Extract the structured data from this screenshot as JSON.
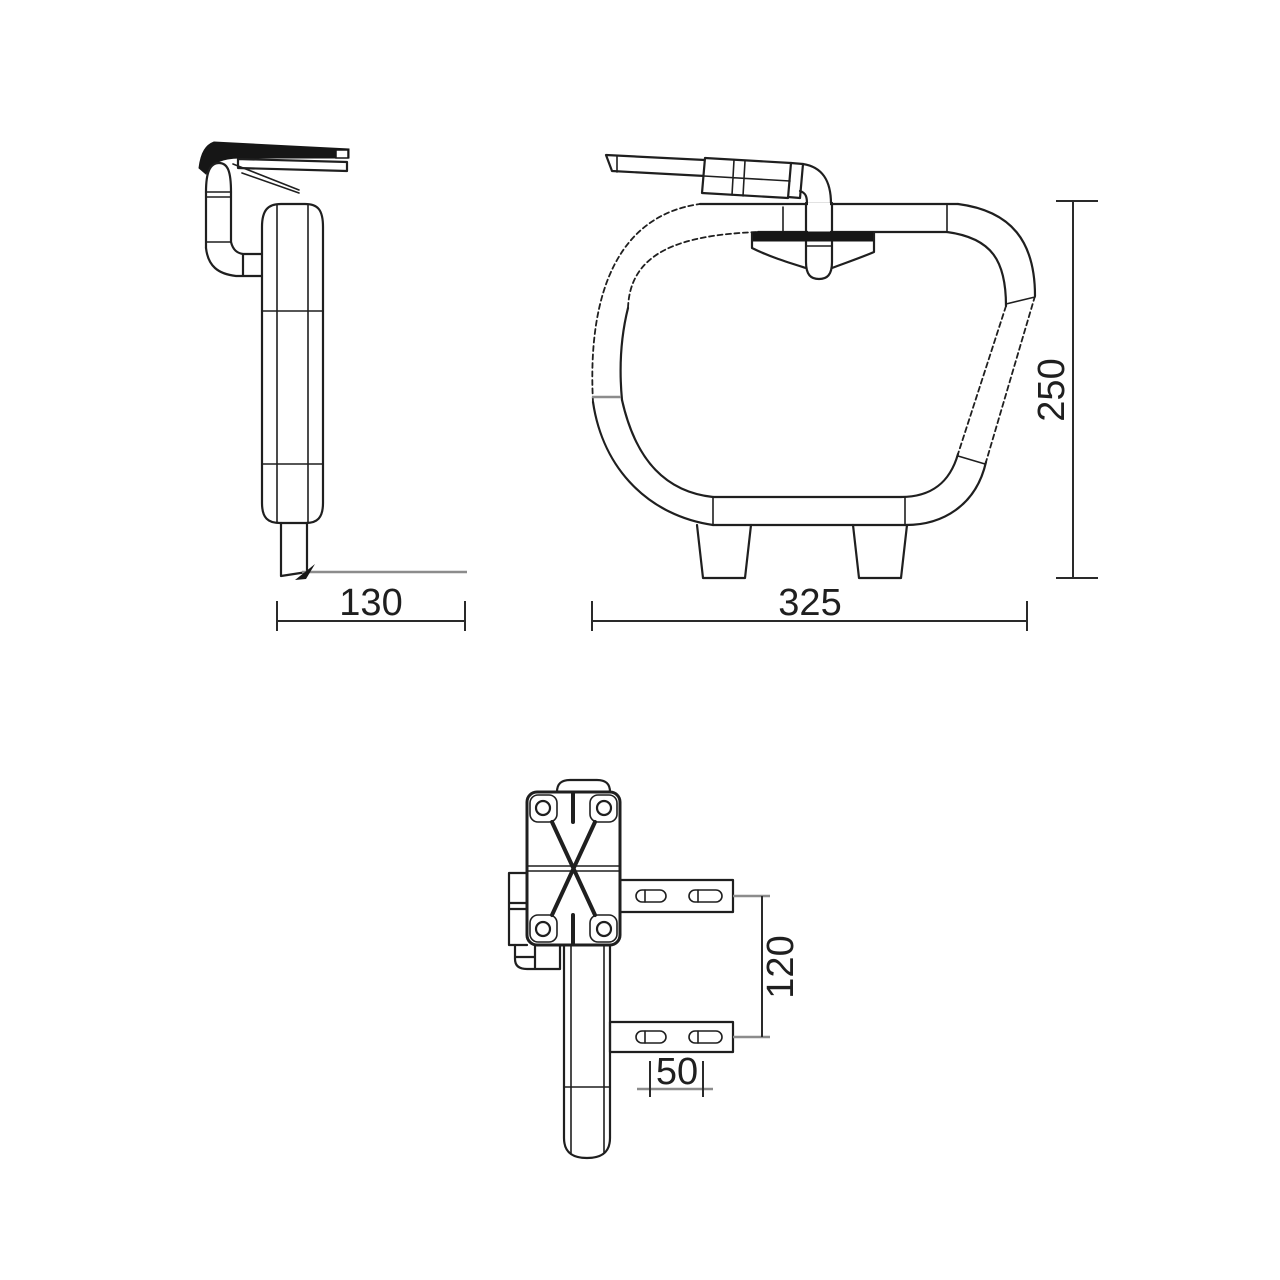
{
  "drawing": {
    "type": "technical-dimension-drawing",
    "dimensions": {
      "side_depth": "130",
      "front_width": "325",
      "front_height": "250",
      "bracket_vertical_spacing": "120",
      "slot_spacing": "50"
    },
    "colors": {
      "line": "#1f1f1f",
      "muted_line": "#8c8c8c",
      "background": "#ffffff"
    }
  }
}
